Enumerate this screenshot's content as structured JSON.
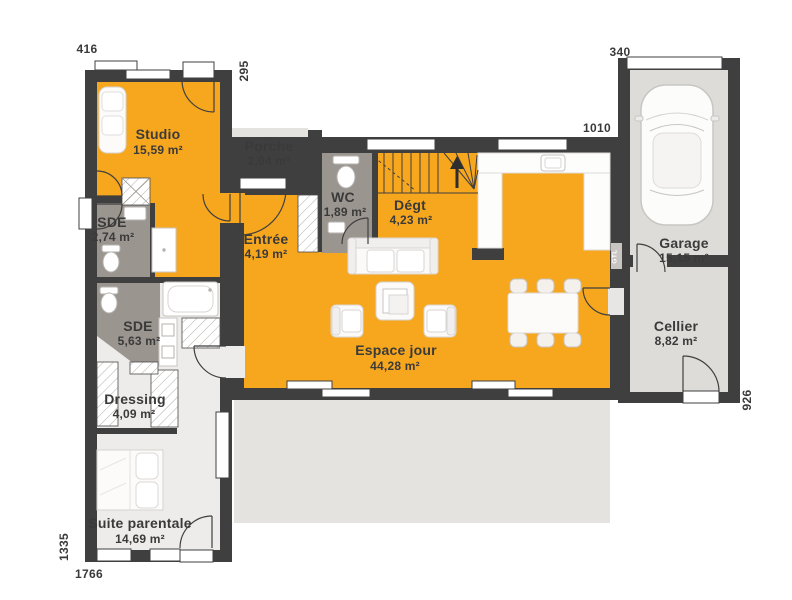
{
  "plan": {
    "rooms": [
      {
        "name": "Studio",
        "area": "15,59 m²"
      },
      {
        "name": "Porche",
        "area": "2,04 m²"
      },
      {
        "name": "WC",
        "area": "1,89 m²"
      },
      {
        "name": "Dégt",
        "area": "4,23 m²"
      },
      {
        "name": "SDE",
        "area": "2,74 m²"
      },
      {
        "name": "Entrée",
        "area": "4,19 m²"
      },
      {
        "name": "Espace jour",
        "area": "44,28 m²"
      },
      {
        "name": "SDE",
        "area": "5,63 m²"
      },
      {
        "name": "Dressing",
        "area": "4,09 m²"
      },
      {
        "name": "Suite parentale",
        "area": "14,69 m²"
      },
      {
        "name": "Garage",
        "area": "15,15 m²"
      },
      {
        "name": "Cellier",
        "area": "8,82 m²"
      }
    ],
    "dimensions": {
      "top_left": "416",
      "left_wing_depth": "295",
      "garage_width": "340",
      "main_width": "1010",
      "right_height": "926",
      "left_height": "1335",
      "bottom_width": "1766"
    },
    "annotations": {
      "gtl": "GTL"
    },
    "colors": {
      "day_area": "#F7A71E",
      "wet_room": "#9B9590",
      "night_area": "#EDECEA",
      "annex_floor": "#DEDCD9",
      "outdoor": "#E5E3E0",
      "wall": "#3F3F3F"
    }
  }
}
